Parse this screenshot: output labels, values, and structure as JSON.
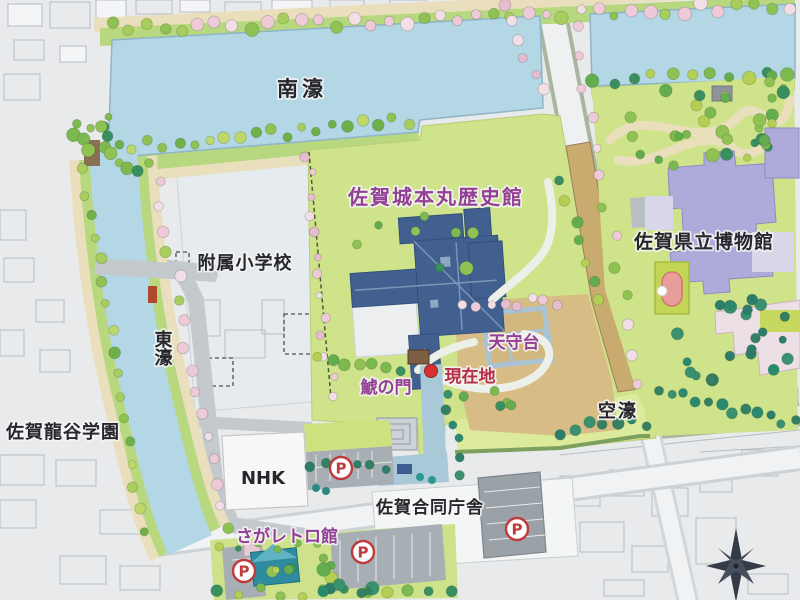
{
  "map_sign": {
    "description": "Illustrated area guide map of the Saga Castle park district",
    "labels": {
      "south_moat": {
        "text": "南濠"
      },
      "honmaru_museum": {
        "text": "佐賀城本丸歴史館"
      },
      "prefectural_museum": {
        "text": "佐賀県立博物館"
      },
      "elementary_school": {
        "text": "附属小学校"
      },
      "east_moat": {
        "text": "東濠"
      },
      "ryukoku_gakuen": {
        "text": "佐賀龍谷学園"
      },
      "tenshudai": {
        "text": "天守台"
      },
      "current_location": {
        "text": "現在地"
      },
      "shachi_gate": {
        "text": "鯱の門"
      },
      "dry_moat": {
        "text": "空濠"
      },
      "nhk": {
        "text": "NHK"
      },
      "joint_govt_building": {
        "text": "佐賀合同庁舎"
      },
      "retro_kan": {
        "text": "さがレトロ館"
      },
      "parking_letter": "P"
    },
    "markers": {
      "current_location": {
        "x": 431,
        "y": 371,
        "color": "#d63031"
      },
      "parking": [
        {
          "x": 341,
          "y": 468
        },
        {
          "x": 244,
          "y": 571
        },
        {
          "x": 363,
          "y": 552
        },
        {
          "x": 517,
          "y": 529
        }
      ]
    },
    "colors": {
      "background": "#e9eaec",
      "water": "#b4d7e6",
      "water_edge": "#8fb4c8",
      "lawn_green": "#cfe38a",
      "dry_moat_green": "#dcea9c",
      "bank_green": "#b7d87f",
      "path_tan": "#eadfbd",
      "road_gray": "#c3c9cc",
      "street_white": "#f1f2f3",
      "museum_building_blue": "#41608f",
      "prefectural_museum_lavender": "#aeabdb",
      "tenshudai_tan": "#d7bd85",
      "castle_wall_tan": "#c9ab70",
      "parking_gray": "#a7aeb4",
      "retro_building_teal": "#2f8ba0",
      "parking_icon_red": "#bf3a3a",
      "label_purple": "#933e97",
      "label_red": "#b52d49",
      "label_black": "#26262c",
      "compass_dark": "#323b46"
    },
    "decor": {
      "palettes": {
        "g": [
          "#64ad4e",
          "#8fc253",
          "#3a8f5f",
          "#b5cf55",
          "#7cba4f"
        ],
        "l": [
          "#8fc253",
          "#a8cd5e",
          "#bdd76a",
          "#6fb04b"
        ],
        "p": [
          "#eec9d8",
          "#f3dde6",
          "#8fc253",
          "#a8cd5e",
          "#eec9d8"
        ],
        "pk": [
          "#eec9d8",
          "#f3dde6",
          "#e8bccf"
        ],
        "d": [
          "#2e7d6b",
          "#357f63",
          "#2a8a70",
          "#3a9170"
        ]
      },
      "tree_lines": [
        [
          112,
          30,
          788,
          4,
          40,
          "p",
          4,
          7
        ],
        [
          118,
          148,
          408,
          122,
          20,
          "l",
          4,
          6
        ],
        [
          594,
          80,
          788,
          70,
          11,
          "g",
          4,
          7
        ],
        [
          84,
          170,
          146,
          532,
          17,
          "l",
          4,
          6
        ],
        [
          152,
          162,
          226,
          528,
          17,
          "p",
          4,
          6
        ],
        [
          309,
          154,
          331,
          396,
          13,
          "pk",
          3,
          5
        ],
        [
          574,
          28,
          640,
          382,
          13,
          "p",
          4,
          6
        ],
        [
          658,
          392,
          794,
          424,
          12,
          "d",
          4,
          6
        ],
        [
          216,
          594,
          452,
          588,
          12,
          "g",
          4,
          6
        ],
        [
          218,
          546,
          316,
          540,
          6,
          "g",
          3,
          5
        ],
        [
          449,
          392,
          459,
          474,
          6,
          "d",
          4,
          5
        ],
        [
          312,
          464,
          386,
          470,
          6,
          "d",
          4,
          5
        ],
        [
          464,
          308,
          558,
          300,
          8,
          "pk",
          4,
          5
        ],
        [
          318,
          356,
          400,
          368,
          7,
          "g",
          4,
          6
        ],
        [
          74,
          136,
          138,
          172,
          8,
          "g",
          4,
          7
        ],
        [
          560,
          432,
          648,
          420,
          7,
          "d",
          4,
          6
        ],
        [
          562,
          182,
          602,
          298,
          7,
          "g",
          4,
          6
        ],
        [
          500,
          8,
          546,
          88,
          6,
          "pk",
          4,
          6
        ]
      ],
      "tree_clusters": [
        [
          688,
          128,
          92,
          40,
          26,
          "g"
        ],
        [
          733,
          340,
          62,
          46,
          22,
          "d"
        ],
        [
          428,
          252,
          85,
          38,
          8,
          "g"
        ],
        [
          478,
          398,
          38,
          16,
          5,
          "g"
        ],
        [
          300,
          566,
          44,
          22,
          8,
          "g"
        ],
        [
          770,
          96,
          22,
          32,
          8,
          "g"
        ],
        [
          90,
          120,
          28,
          26,
          6,
          "g"
        ],
        [
          345,
          588,
          40,
          10,
          6,
          "d"
        ]
      ]
    }
  }
}
